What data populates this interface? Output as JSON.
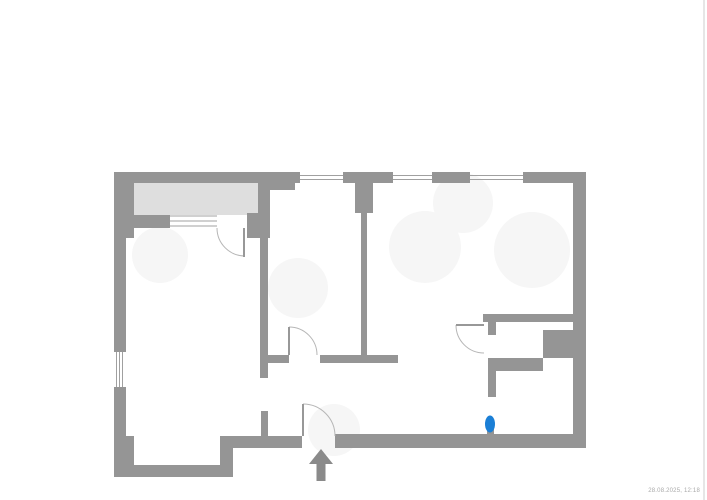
{
  "document": {
    "timestamp": "28.08.2025, 12:18"
  },
  "colors": {
    "wall": "#959595",
    "balcony_fill": "#dedede",
    "window_line": "#a0a0a0",
    "door_arc": "#b6b6b6",
    "door_leaf": "#989898",
    "marker_blue": "#1b7fd6",
    "arrow": "#8a8a8a",
    "smudge": "#f6f6f6",
    "page_edge": "#e6e6e6",
    "timestamp_text": "#a9a9a9"
  },
  "floorplan": {
    "canvas": {
      "width": 707,
      "height": 500
    },
    "balcony": {
      "name": "balcony-area",
      "x": 134,
      "y": 182,
      "w": 124,
      "h": 33
    },
    "walls": [
      {
        "name": "top-wall-segment-1",
        "x": 114,
        "y": 172,
        "w": 186,
        "h": 11
      },
      {
        "name": "top-wall-segment-2",
        "x": 343,
        "y": 172,
        "w": 50,
        "h": 11
      },
      {
        "name": "top-wall-segment-3",
        "x": 432,
        "y": 172,
        "w": 38,
        "h": 11
      },
      {
        "name": "top-wall-segment-4",
        "x": 523,
        "y": 172,
        "w": 63,
        "h": 11
      },
      {
        "name": "top-wall-notch",
        "x": 270,
        "y": 183,
        "w": 25,
        "h": 7
      },
      {
        "name": "left-wall-upper-thick",
        "x": 114,
        "y": 172,
        "w": 20,
        "h": 66
      },
      {
        "name": "left-wall-mid",
        "x": 114,
        "y": 238,
        "w": 12,
        "h": 114
      },
      {
        "name": "left-wall-lower",
        "x": 114,
        "y": 387,
        "w": 12,
        "h": 49
      },
      {
        "name": "left-wall-bottom-thick",
        "x": 114,
        "y": 436,
        "w": 20,
        "h": 41
      },
      {
        "name": "bottom-wall-left",
        "x": 114,
        "y": 465,
        "w": 119,
        "h": 12
      },
      {
        "name": "bottom-wall-step-riser",
        "x": 220,
        "y": 436,
        "w": 13,
        "h": 41
      },
      {
        "name": "bottom-wall-mid",
        "x": 220,
        "y": 436,
        "w": 82,
        "h": 12
      },
      {
        "name": "entry-hall-stub",
        "x": 261,
        "y": 411,
        "w": 7,
        "h": 25
      },
      {
        "name": "bottom-wall-right",
        "x": 335,
        "y": 434,
        "w": 250,
        "h": 14
      },
      {
        "name": "right-wall",
        "x": 573,
        "y": 172,
        "w": 13,
        "h": 276
      },
      {
        "name": "balcony-right-wall",
        "x": 258,
        "y": 181,
        "w": 12,
        "h": 32
      },
      {
        "name": "balcony-pier",
        "x": 247,
        "y": 213,
        "w": 23,
        "h": 25
      },
      {
        "name": "balcony-bottom-wall",
        "x": 126,
        "y": 215,
        "w": 44,
        "h": 13
      },
      {
        "name": "hall-left-wall",
        "x": 260,
        "y": 238,
        "w": 8,
        "h": 140
      },
      {
        "name": "hall-bottom-wall-left",
        "x": 260,
        "y": 355,
        "w": 29,
        "h": 8
      },
      {
        "name": "hall-bottom-wall-right",
        "x": 320,
        "y": 355,
        "w": 78,
        "h": 8
      },
      {
        "name": "partition-wall-top",
        "x": 355,
        "y": 183,
        "w": 18,
        "h": 30
      },
      {
        "name": "partition-wall",
        "x": 361,
        "y": 213,
        "w": 6,
        "h": 146
      },
      {
        "name": "bath-top-wall",
        "x": 483,
        "y": 314,
        "w": 90,
        "h": 8
      },
      {
        "name": "bath-door-jamb",
        "x": 488,
        "y": 321,
        "w": 8,
        "h": 14
      },
      {
        "name": "duct-block",
        "x": 543,
        "y": 330,
        "w": 30,
        "h": 28
      },
      {
        "name": "duct-step-horizontal",
        "x": 488,
        "y": 358,
        "w": 55,
        "h": 13
      },
      {
        "name": "duct-step-vertical",
        "x": 488,
        "y": 371,
        "w": 8,
        "h": 26
      },
      {
        "name": "marker-wall-stub",
        "x": 487,
        "y": 428,
        "w": 7,
        "h": 10
      }
    ],
    "windows": [
      {
        "name": "window-top-1",
        "type": "h",
        "x1": 300,
        "x2": 343,
        "ys": [
          175.5,
          179.5
        ]
      },
      {
        "name": "window-top-2",
        "type": "h",
        "x1": 393,
        "x2": 432,
        "ys": [
          175.5,
          179.5
        ]
      },
      {
        "name": "window-top-3",
        "type": "h",
        "x1": 470,
        "x2": 523,
        "ys": [
          175.5,
          179.5
        ]
      },
      {
        "name": "window-balcony",
        "type": "h",
        "x1": 170,
        "x2": 217,
        "ys": [
          216,
          221,
          226
        ]
      },
      {
        "name": "window-left",
        "type": "v",
        "y1": 352,
        "y2": 387,
        "xs": [
          116.5,
          119.5,
          122.5
        ]
      }
    ],
    "doors": [
      {
        "name": "door-balcony",
        "leaf": {
          "x1": 244,
          "y1": 228,
          "x2": 244,
          "y2": 257
        },
        "arc": "M217,228 A28,28 0 0 0 245,256"
      },
      {
        "name": "door-hall",
        "leaf": {
          "x1": 289,
          "y1": 327,
          "x2": 289,
          "y2": 355
        },
        "arc": "M289,327 A28,28 0 0 1 317,355"
      },
      {
        "name": "door-bath",
        "leaf": {
          "x1": 456,
          "y1": 325,
          "x2": 484,
          "y2": 325
        },
        "arc": "M456,325 A28,28 0 0 0 484,353"
      },
      {
        "name": "door-entrance",
        "leaf": {
          "x1": 303,
          "y1": 404,
          "x2": 303,
          "y2": 436
        },
        "arc": "M303,404 A32,32 0 0 1 335,436"
      }
    ],
    "marker": {
      "name": "blue-position-marker",
      "cx": 490,
      "cy": 424,
      "rx": 5,
      "ry": 8.5
    },
    "arrow": {
      "name": "entrance-arrow",
      "head": "309,464 333,464 321,449",
      "stem": {
        "x": 316.5,
        "y": 462,
        "w": 9,
        "h": 19
      }
    },
    "smudges": [
      {
        "cx": 298,
        "cy": 288,
        "r": 30
      },
      {
        "cx": 425,
        "cy": 247,
        "r": 36
      },
      {
        "cx": 532,
        "cy": 250,
        "r": 38
      },
      {
        "cx": 334,
        "cy": 430,
        "r": 26
      },
      {
        "cx": 160,
        "cy": 255,
        "r": 28
      },
      {
        "cx": 463,
        "cy": 203,
        "r": 30
      }
    ],
    "page_edge": {
      "name": "scan-page-edge",
      "x": 703,
      "y": 0,
      "w": 2,
      "h": 500
    }
  }
}
